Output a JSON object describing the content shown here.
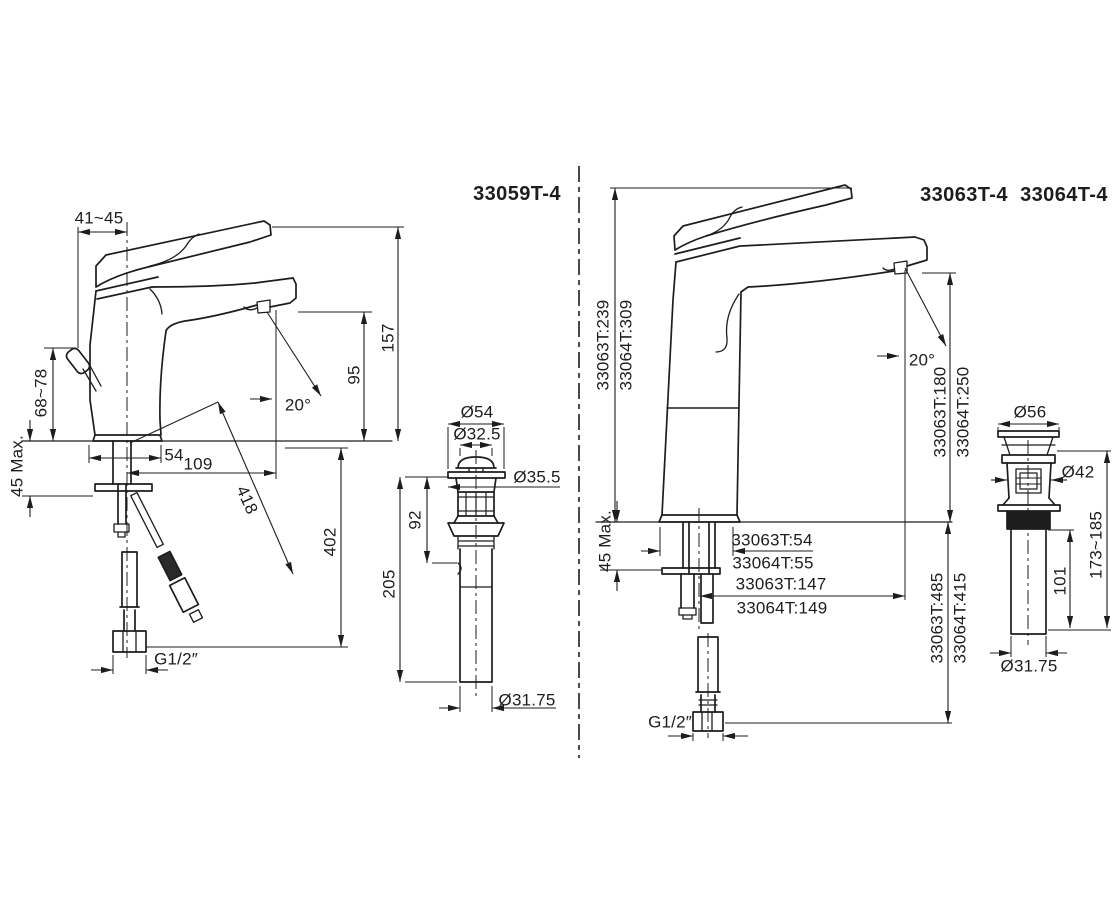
{
  "page": {
    "background": "#ffffff",
    "line_color": "#1d1d1d"
  },
  "left_drawing": {
    "model": "33059T-4",
    "dims": {
      "handle_offset": "41~45",
      "lever_height": "68~78",
      "deck_thickness_max": "45 Max.",
      "base_width": "54",
      "spout_reach": "109",
      "hose_length": "418",
      "spout_angle": "20°",
      "spout_height": "95",
      "overall_height": "157",
      "below_deck_length": "402",
      "inlet_thread": "G1/2″"
    },
    "drain": {
      "flange_dia": "Ø54",
      "plug_dia": "Ø32.5",
      "body_dia": "Ø35.5",
      "upper_length": "92",
      "overall_length": "205",
      "tailpiece_dia": "Ø31.75"
    }
  },
  "right_drawing": {
    "model_a": "33063T-4",
    "model_b": "33064T-4",
    "dims": {
      "overall_height_a": "33063T:239",
      "overall_height_b": "33064T:309",
      "spout_height_a": "33063T:180",
      "spout_height_b": "33064T:250",
      "spout_angle": "20°",
      "deck_thickness_max": "45 Max.",
      "base_width_a": "33063T:54",
      "base_width_b": "33064T:55",
      "spout_reach_a": "33063T:147",
      "spout_reach_b": "33064T:149",
      "below_deck_length_a": "33063T:485",
      "below_deck_length_b": "33064T:415",
      "inlet_thread": "G1/2″"
    },
    "drain": {
      "cap_dia": "Ø56",
      "body_dia": "Ø42",
      "overall_length": "173~185",
      "tailpiece_length": "101",
      "tailpiece_dia": "Ø31.75"
    }
  }
}
